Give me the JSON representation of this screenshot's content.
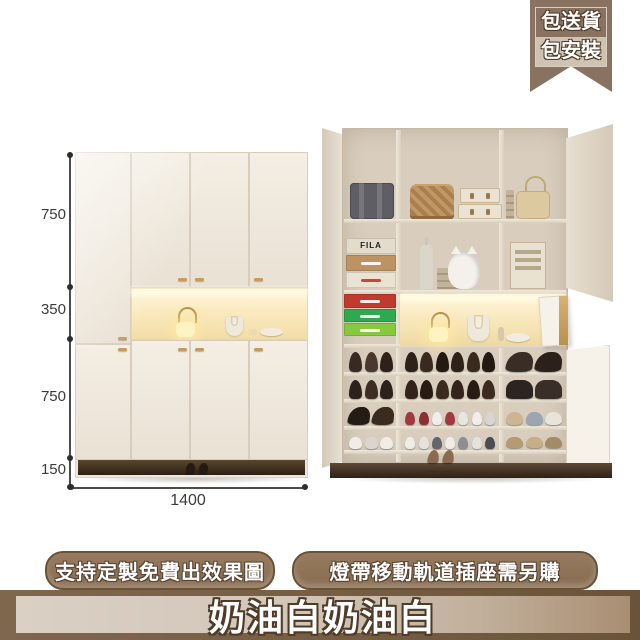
{
  "ribbon": {
    "line1": "包送貨",
    "line2": "包安裝",
    "bg": "#8a7260"
  },
  "dimensions": {
    "heights": [
      "750",
      "350",
      "750",
      "150"
    ],
    "width": "1400"
  },
  "product": {
    "box_brand": "FILA"
  },
  "labels": {
    "left_pill": "支持定製免費出效果圖",
    "right_pill": "燈帶移動軌道插座需另購"
  },
  "banner": {
    "text": "奶油白奶油白"
  },
  "colors": {
    "accent_brown": "#8a7260",
    "cabinet_cream": "#eee6d9",
    "niche_light": "#fbeabf",
    "floor_dark": "#2e2115"
  },
  "scene": {
    "shoe_columns": [
      {
        "x": 346,
        "w": 50,
        "rows": [
          {
            "y": 348,
            "h": 24,
            "count": 3,
            "kind": "pump",
            "colors": [
              "#362a22",
              "#4b382c",
              "#2f2119"
            ]
          },
          {
            "y": 376,
            "h": 23,
            "count": 3,
            "kind": "pump",
            "colors": [
              "#2c211c",
              "#3d2e24",
              "#2c211c"
            ]
          },
          {
            "y": 403,
            "h": 22,
            "count": 2,
            "kind": "heel",
            "colors": [
              "#241b15",
              "#3a2b1f"
            ]
          },
          {
            "y": 428,
            "h": 21,
            "count": 3,
            "kind": "sneaker",
            "colors": [
              "#efede8",
              "#dad6cf",
              "#efede8"
            ]
          }
        ]
      },
      {
        "x": 402,
        "w": 96,
        "rows": [
          {
            "y": 348,
            "h": 24,
            "count": 6,
            "kind": "pump",
            "colors": [
              "#2e2118",
              "#3a2a1e",
              "#241a12"
            ]
          },
          {
            "y": 376,
            "h": 23,
            "count": 6,
            "kind": "pump",
            "colors": [
              "#33231a",
              "#271b12",
              "#3c2b1f"
            ]
          },
          {
            "y": 403,
            "h": 22,
            "count": 7,
            "kind": "sneaker",
            "colors": [
              "#a13a3f",
              "#8c3038",
              "#f0eeea",
              "#a13a3f",
              "#e8e6e1",
              "#f0eeea",
              "#d9d6d0"
            ]
          },
          {
            "y": 428,
            "h": 21,
            "count": 7,
            "kind": "sneaker",
            "colors": [
              "#efede8",
              "#e4e2dc",
              "#63666c",
              "#efede8",
              "#8b8e94",
              "#e4e2dc",
              "#4a4d53"
            ]
          }
        ]
      },
      {
        "x": 504,
        "w": 60,
        "rows": [
          {
            "y": 348,
            "h": 24,
            "count": 2,
            "kind": "heel",
            "colors": [
              "#3a2d26",
              "#2c211a"
            ]
          },
          {
            "y": 376,
            "h": 23,
            "count": 2,
            "kind": "boot",
            "colors": [
              "#2c2420",
              "#3a2f28"
            ]
          },
          {
            "y": 403,
            "h": 22,
            "count": 3,
            "kind": "sneaker",
            "colors": [
              "#cdb592",
              "#9aa6b2",
              "#e8e4da"
            ]
          },
          {
            "y": 428,
            "h": 20,
            "count": 3,
            "kind": "sneaker",
            "colors": [
              "#b69a74",
              "#c7ae88",
              "#a58a66"
            ]
          }
        ]
      }
    ]
  }
}
